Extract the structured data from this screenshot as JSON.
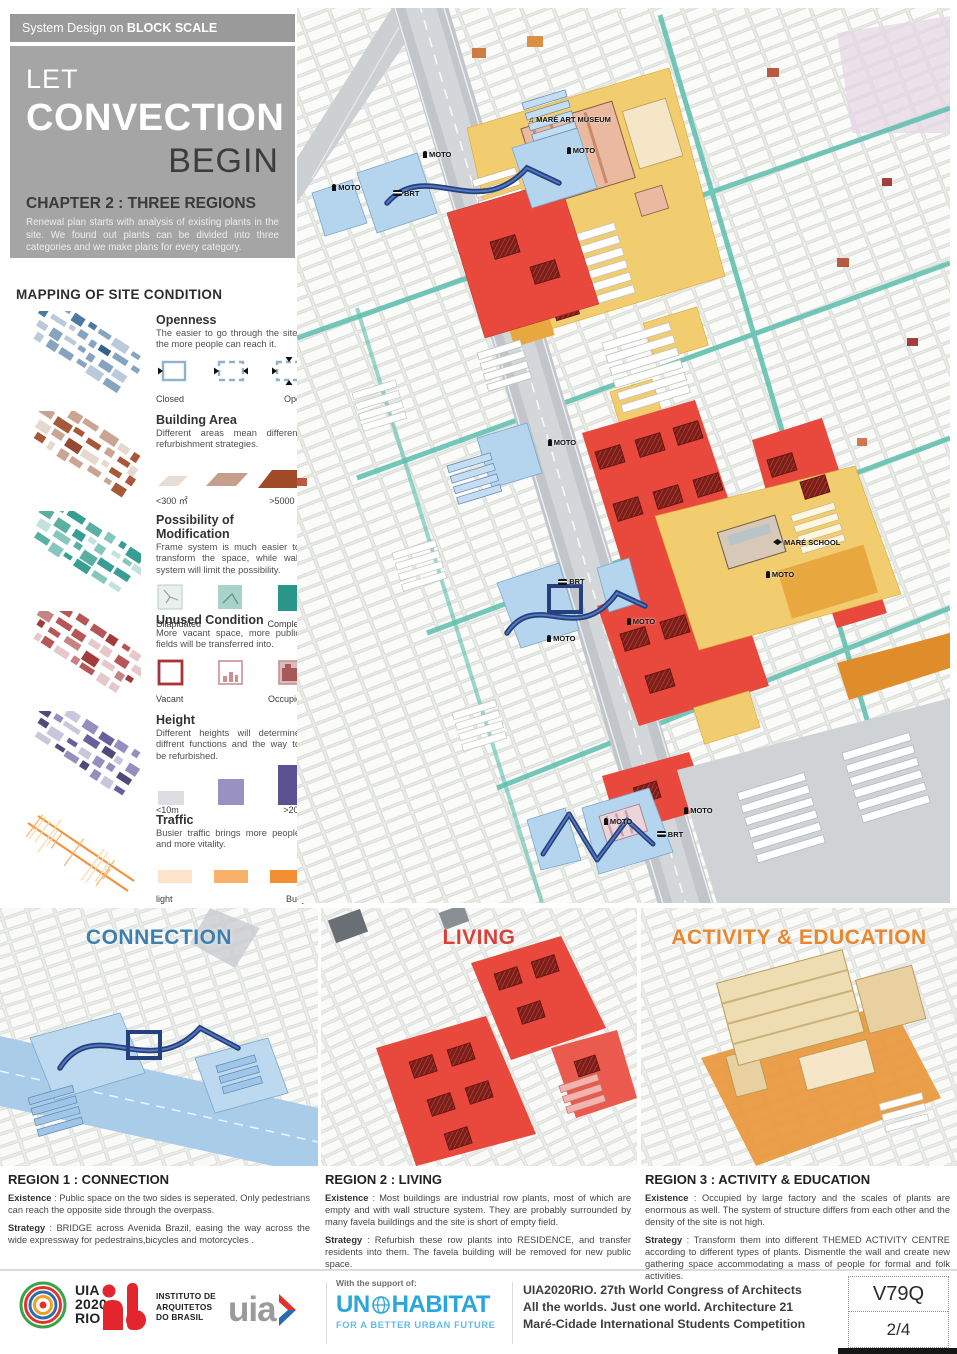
{
  "header": {
    "kicker_prefix": "System Design on ",
    "kicker_bold": "BLOCK SCALE",
    "title_line1": "LET",
    "title_line2": "CONVECTION",
    "title_line3": "BEGIN",
    "chapter": "CHAPTER 2 : THREE REGIONS",
    "intro": "Renewal plan starts with analysis of existing plants in the site. We found out plants can be divided into three categories and we make plans for every category."
  },
  "legend": {
    "title": "MAPPING OF SITE CONDITION",
    "items": [
      {
        "name": "Openness",
        "type": "openness",
        "desc": "The easier to go through the site, the more people can reach it.",
        "labels": [
          "Closed",
          "Open"
        ],
        "thumb_colors": [
          "#24527e",
          "#3e6f9c",
          "#7c9cbb",
          "#b3c6d8"
        ],
        "swatch_colors": [
          "#8fb3cc",
          "#111111"
        ]
      },
      {
        "name": "Building Area",
        "type": "area",
        "desc": "Different areas mean different refurbishment strategies.",
        "labels": [
          "<300 ㎡",
          ">5000 ㎡"
        ],
        "thumb_colors": [
          "#a04a28",
          "#c79d8b",
          "#e3d5cb",
          "#8c3a1e"
        ],
        "swatch_colors": [
          "#e7ddd3",
          "#c79d8b",
          "#a04a28"
        ]
      },
      {
        "name": "Possibility of Modification",
        "type": "modification",
        "desc": "Frame system is much easier to transform the space, while wall system will limit the possibility.",
        "labels": [
          "Dilapidated",
          "Complete"
        ],
        "thumb_colors": [
          "#27968a",
          "#7cc2b7",
          "#bfe0da",
          "#4aa89a"
        ],
        "swatch_colors": [
          "#e9f0ee",
          "#a9d2c9",
          "#2a968a"
        ]
      },
      {
        "name": "Unused Condition",
        "type": "unused",
        "desc": "More vacant space, more public fields will be transferred into.",
        "labels": [
          "Vacant",
          "Occupied"
        ],
        "thumb_colors": [
          "#9c2a2a",
          "#c27878",
          "#e3c3c3",
          "#b04848"
        ],
        "swatch_colors": [
          "#a83434",
          "#cf8f8f",
          "#d9bcbc",
          "#a85858"
        ]
      },
      {
        "name": "Height",
        "type": "height",
        "desc": "Different heights will determine diffrent functions and the way to be refurbished.",
        "labels": [
          "<10m",
          ">20m"
        ],
        "thumb_colors": [
          "#5c5292",
          "#8d84b8",
          "#c6c2da",
          "#413a6e"
        ],
        "swatch_colors": [
          "#dcdce3",
          "#9991bf",
          "#5c5292"
        ]
      },
      {
        "name": "Traffic",
        "type": "traffic",
        "desc": "Busier traffic brings more people and more vitality.",
        "labels": [
          "light",
          "Busy"
        ],
        "thumb_colors": [
          "#f28f35",
          "#f7b269",
          "#fbd9ae"
        ],
        "swatch_colors": [
          "#fbe4ca",
          "#f9b169",
          "#f28f35"
        ]
      }
    ]
  },
  "map": {
    "labels": [
      {
        "text": "MARÉ ART MUSEUM",
        "icon": "music-icon",
        "x": 35.4,
        "y": 12.0
      },
      {
        "text": "MOTO",
        "icon": "moto-icon",
        "x": 19.3,
        "y": 15.9
      },
      {
        "text": "MOTO",
        "icon": "moto-icon",
        "x": 41.3,
        "y": 15.4
      },
      {
        "text": "MOTO",
        "icon": "moto-icon",
        "x": 5.4,
        "y": 19.6
      },
      {
        "text": "BRT",
        "icon": "bus-icon",
        "x": 14.7,
        "y": 20.2
      },
      {
        "text": "MOTO",
        "icon": "moto-icon",
        "x": 38.4,
        "y": 48.0
      },
      {
        "text": "BRT",
        "icon": "bus-icon",
        "x": 40.0,
        "y": 63.6
      },
      {
        "text": "MOTO",
        "icon": "moto-icon",
        "x": 50.5,
        "y": 68.0
      },
      {
        "text": "MOTO",
        "icon": "moto-icon",
        "x": 38.3,
        "y": 69.9
      },
      {
        "text": "MARÉ SCHOOL",
        "icon": "school-icon",
        "x": 72.9,
        "y": 59.2
      },
      {
        "text": "MOTO",
        "icon": "moto-icon",
        "x": 71.8,
        "y": 62.8
      },
      {
        "text": "MOTO",
        "icon": "moto-icon",
        "x": 59.3,
        "y": 89.2
      },
      {
        "text": "MOTO",
        "icon": "moto-icon",
        "x": 47.0,
        "y": 90.4
      },
      {
        "text": "BRT",
        "icon": "bus-icon",
        "x": 55.1,
        "y": 91.8
      }
    ]
  },
  "panels": [
    {
      "title": "CONNECTION",
      "color": "#3f7fae"
    },
    {
      "title": "LIVING",
      "color": "#d8423a"
    },
    {
      "title": "ACTIVITY & EDUCATION",
      "color": "#e8872f"
    }
  ],
  "regions": [
    {
      "title": "REGION 1 : CONNECTION",
      "existence_label": "Existence",
      "existence": " : Public space on the two sides is seperated. Only pedestrians can reach the opposite side through the overpass.",
      "strategy_label": "Strategy",
      "strategy": " : BRIDGE across Avenida Brazil, easing the way across the wide expressway for pedestrains,bicycles and motorcycles ."
    },
    {
      "title": "REGION 2 : LIVING",
      "existence_label": "Existence",
      "existence": " : Most buildings are industrial row plants, most of which are empty and with wall structure system. They are probably surrounded by many favela buildings and the site is short of empty field.",
      "strategy_label": "Strategy",
      "strategy": " : Refurbish these row plants into RESIDENCE, and transfer residents into them. The favela building will be removed for new public space."
    },
    {
      "title": "REGION 3 : ACTIVITY & EDUCATION",
      "existence_label": "Existence",
      "existence": " : Occupied by large factory and the scales of plants are enormous as well. The system of structure differs from each other and the density of the site is not high.",
      "strategy_label": "Strategy",
      "strategy": " : Transform them into different THEMED ACTIVITY CENTRE according to different types of plants. Dismentle the wall and create new gathering space accommodating a mass of people for formal and folk activities."
    }
  ],
  "footer": {
    "uia2020_line1": "UIA",
    "uia2020_line2": "2020",
    "uia2020_line3": "RIO",
    "iab_line1": "INSTITUTO DE",
    "iab_line2": "ARQUITETOS",
    "iab_line3": "DO BRASIL",
    "uia_wordmark": "uia",
    "support_label": "With the support of:",
    "unhabitat_left": "UN",
    "unhabitat_right": "HABITAT",
    "unhabitat_tagline": "FOR A BETTER URBAN FUTURE",
    "congress_line1": "UIA2020RIO. 27th World Congress of Architects",
    "congress_line2": "All the worlds. Just one world. Architecture 21",
    "congress_line3": "Maré-Cidade International Students Competition",
    "code": "V79Q",
    "page": "2/4"
  }
}
